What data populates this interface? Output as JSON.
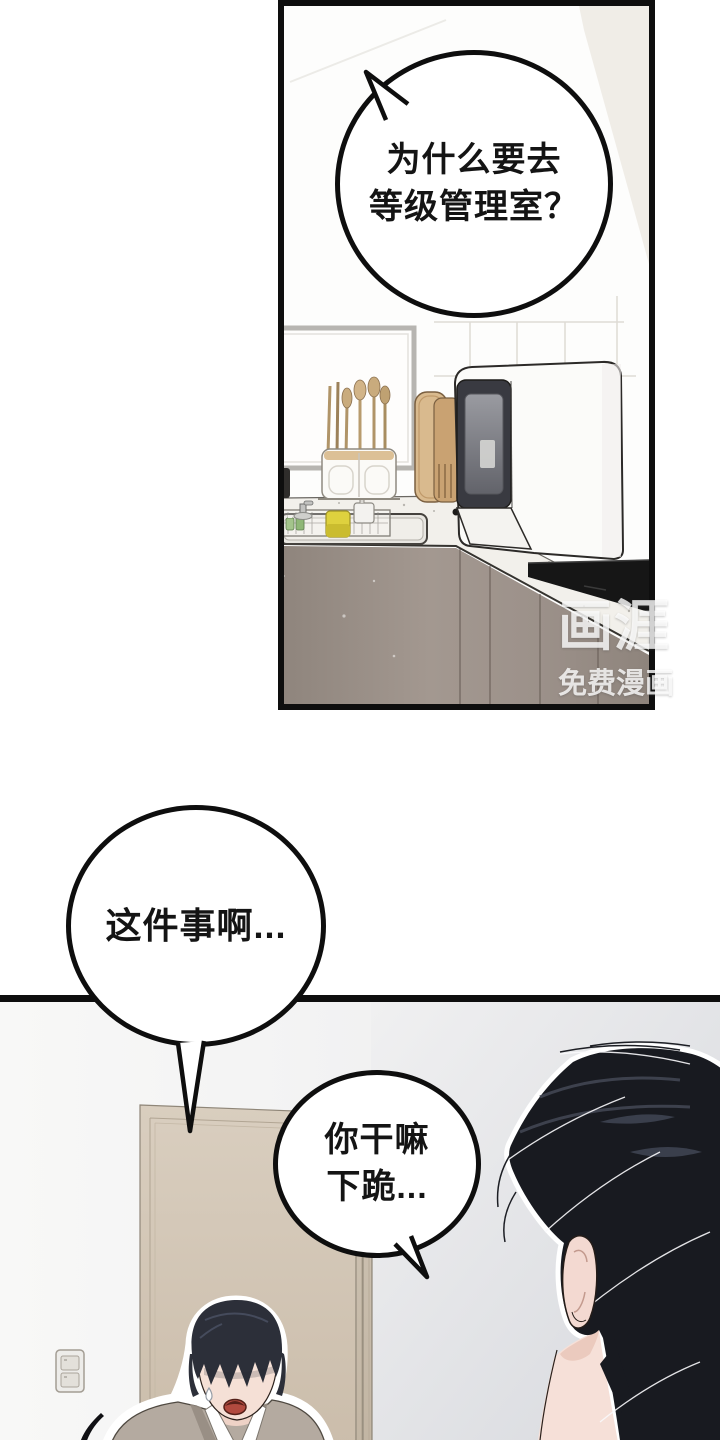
{
  "bubbles": {
    "bubble1": {
      "line1": "为什么要去",
      "line2": "等级管理室？"
    },
    "bubble2": {
      "text": "这件事啊..."
    },
    "bubble3": {
      "line1": "你干嘛",
      "line2": "下跪..."
    }
  },
  "watermark": {
    "logo": "画涯",
    "subtitle": "免费漫画"
  },
  "colors": {
    "panel_border": "#0e0e0e",
    "cabinet_taupe": "#9d9189",
    "counter_white": "#f2f0eb",
    "cooktop_black": "#161616",
    "door_tan": "#d3c7b6",
    "wall_gray": "#dfe1e6",
    "hair_black": "#181a20",
    "hair_navy": "#2c2f39",
    "skin": "#f5e0d6",
    "cardigan": "#b4aaa0",
    "sponge_yellow": "#ded13e",
    "bottle_green": "#9dbd85",
    "cutting_board": "#d9ba8e",
    "mouth_red": "#b14a3f"
  }
}
